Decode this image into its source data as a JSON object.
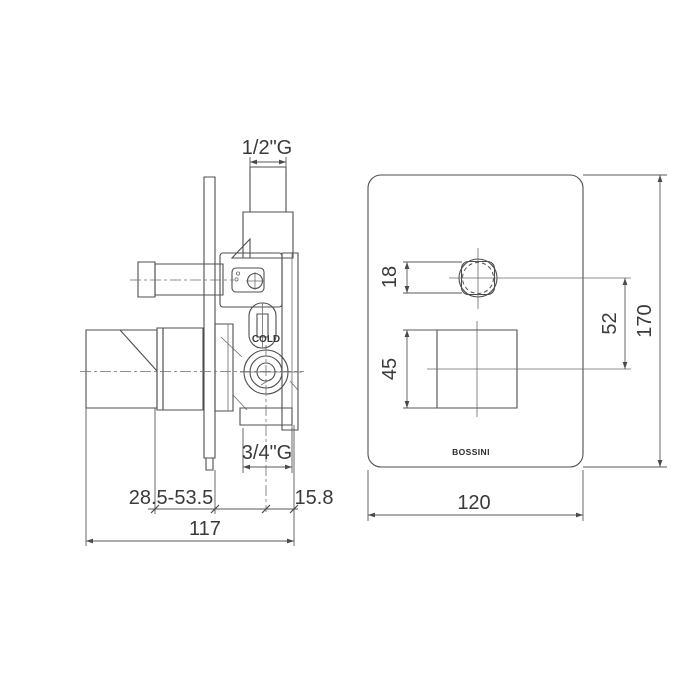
{
  "page": {
    "background": "#ffffff",
    "line_color": "#4f4f4f",
    "text_color": "#3a3a3a"
  },
  "product": {
    "brand": "BOSSINI",
    "cold_label": "COLD"
  },
  "connections": {
    "top_thread": "1/2\"G",
    "bottom_thread": "3/4\"G"
  },
  "dimensions": {
    "side_view": {
      "wall_adjust_range": "28.5-53.5",
      "outlet_edge_offset": "15.8",
      "total_depth": "117"
    },
    "front_view": {
      "knob_diameter": "18",
      "handle_square": "45",
      "knob_to_handle_distance": "52",
      "plate_height": "170",
      "plate_width": "120"
    }
  }
}
